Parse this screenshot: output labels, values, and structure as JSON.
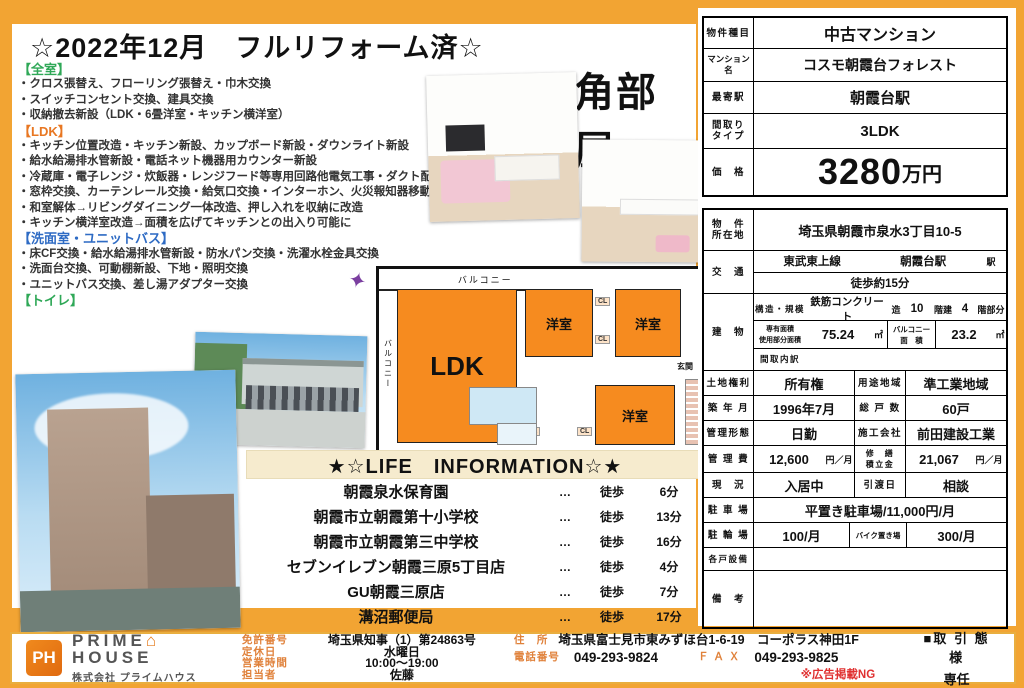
{
  "colors": {
    "background": "#F2A433",
    "room_orange": "#F68B1F",
    "heading_green": "#2FA857",
    "heading_orange": "#E87722",
    "heading_blue": "#2E6BC4",
    "label_orange": "#E0813A",
    "warning_red": "#E03131",
    "life_band": "#F6EBCE"
  },
  "left_panel": {
    "title": "☆2022年12月　フルリフォーム済☆",
    "corner_label": "角部屋",
    "sections": [
      {
        "heading": "【全室】",
        "items": [
          "・クロス張替え、フローリング張替え・巾木交換",
          "・スイッチコンセント交換、建具交換",
          "・収納撤去新設（LDK・6畳洋室・キッチン横洋室）"
        ]
      },
      {
        "heading": "【LDK】",
        "items": [
          "・キッチン位置改造・キッチン新設、カップボード新設・ダウンライト新設",
          "・給水給湯排水管新設・電話ネット機器用カウンター新設",
          "・冷蔵庫・電子レンジ・炊飯器・レンジフード等専用回路他電気工事・ダクト配管",
          "・窓枠交換、カーテンレール交換・給気口交換・インターホン、火災報知器移動",
          "・和室解体→リビングダイニング一体改造、押し入れを収納に改造",
          "・キッチン横洋室改造→面積を広げてキッチンとの出入り可能に"
        ]
      },
      {
        "heading": "【洗面室・ユニットバス】",
        "items": [
          "・床CF交換・給水給湯排水管新設・防水パン交換・洗濯水栓金具交換",
          "・洗面台交換、可動棚新設、下地・照明交換",
          "・ユニットバス交換、差し湯アダプター交換"
        ]
      },
      {
        "heading": "【トイレ】",
        "items": []
      }
    ],
    "floorplan": {
      "balcony_top": "バルコニー",
      "balcony_left": "バルコニー",
      "ldk": "LDK",
      "room1": "洋室",
      "room2": "洋室",
      "room3": "洋室",
      "cl": "CL",
      "genkan": "玄関"
    },
    "life_info": {
      "title": "★☆LIFE　INFORMATION☆★",
      "dots": "…",
      "walk": "徒歩",
      "rows": [
        {
          "name": "朝霞泉水保育園",
          "time": "6分"
        },
        {
          "name": "朝霞市立朝霞第十小学校",
          "time": "13分"
        },
        {
          "name": "朝霞市立朝霞第三中学校",
          "time": "16分"
        },
        {
          "name": "セブンイレブン朝霞三原5丁目店",
          "time": "4分"
        },
        {
          "name": "GU朝霞三原店",
          "time": "7分"
        },
        {
          "name": "溝沼郵便局",
          "time": "17分"
        }
      ]
    }
  },
  "spec": {
    "property_type_label": "物件種目",
    "property_type": "中古マンション",
    "mansion_name_label": "マンション名",
    "mansion_name": "コスモ朝霞台フォレスト",
    "station_label": "最寄駅",
    "station": "朝霞台駅",
    "layout_label": "間取り\nタイプ",
    "layout": "3LDK",
    "price_label": "価　格",
    "price_value": "3280",
    "price_unit": "万円",
    "address_label": "物　件\n所在地",
    "address": "埼玉県朝霞市泉水3丁目10-5",
    "access_label": "交　通",
    "access_line": "東武東上線",
    "access_station": "朝霞台駅",
    "access_station_suffix": "駅",
    "access_walk": "徒歩約15分",
    "building_label": "建　物",
    "structure_label": "構造・規模",
    "structure": "鉄筋コンクリート",
    "structure_zou": "造",
    "floors_total": "10",
    "floors_label": "階建",
    "floor_num": "4",
    "floor_suffix": "階部分",
    "area_label": "専有面積\n使用部分面積",
    "area_value": "75.24",
    "area_unit": "㎡",
    "balcony_label": "バルコニー\n面　積",
    "balcony_value": "23.2",
    "balcony_unit": "㎡",
    "madori_label": "間取内訳",
    "madori": "",
    "land_label": "土地権利",
    "land": "所有権",
    "zoning_label": "用途地域",
    "zoning": "準工業地域",
    "built_label": "築 年 月",
    "built": "1996年7月",
    "units_label": "総 戸 数",
    "units": "60戸",
    "mgmt_type_label": "管理形態",
    "mgmt_type": "日勤",
    "constructor_label": "施工会社",
    "constructor": "前田建設工業",
    "mgmt_fee_label": "管 理 費",
    "mgmt_fee": "12,600",
    "mgmt_fee_unit": "円／月",
    "repair_label": "修　繕\n積立金",
    "repair": "21,067",
    "repair_unit": "円／月",
    "status_label": "現　況",
    "status": "入居中",
    "handover_label": "引渡日",
    "handover": "相談",
    "parking_label": "駐 車 場",
    "parking": "平置き駐車場/11,000円/月",
    "bicycle_label": "駐 輪 場",
    "bicycle": "100/月",
    "bike_label": "バイク置き場",
    "bike": "300/月",
    "equip_label": "各戸設備",
    "equip": "",
    "notes_label": "備　考",
    "notes": ""
  },
  "footer": {
    "logo_mark": "PH",
    "logo_prime": "PRIME",
    "logo_house_icon": "⌂",
    "logo_house": "HOUSE",
    "company": "株式会社 プライムハウス",
    "license_label": "免許番号",
    "license": "埼玉県知事（1）第24863号",
    "holiday_label": "定休日",
    "holiday": "水曜日",
    "hours_label": "営業時間",
    "hours": "10:00～19:00",
    "agent_label": "担当者",
    "agent": "佐藤",
    "address_label": "住　所",
    "address": "埼玉県富士見市東みずほ台1-6-19　コーポラス神田1F",
    "tel_label": "電話番号",
    "tel": "049-293-9824",
    "fax_label": "Ｆ Ａ Ｘ",
    "fax": "049-293-9825",
    "deal_label": "■取 引 態 様",
    "deal": "専任",
    "warning": "※広告掲載NG"
  }
}
